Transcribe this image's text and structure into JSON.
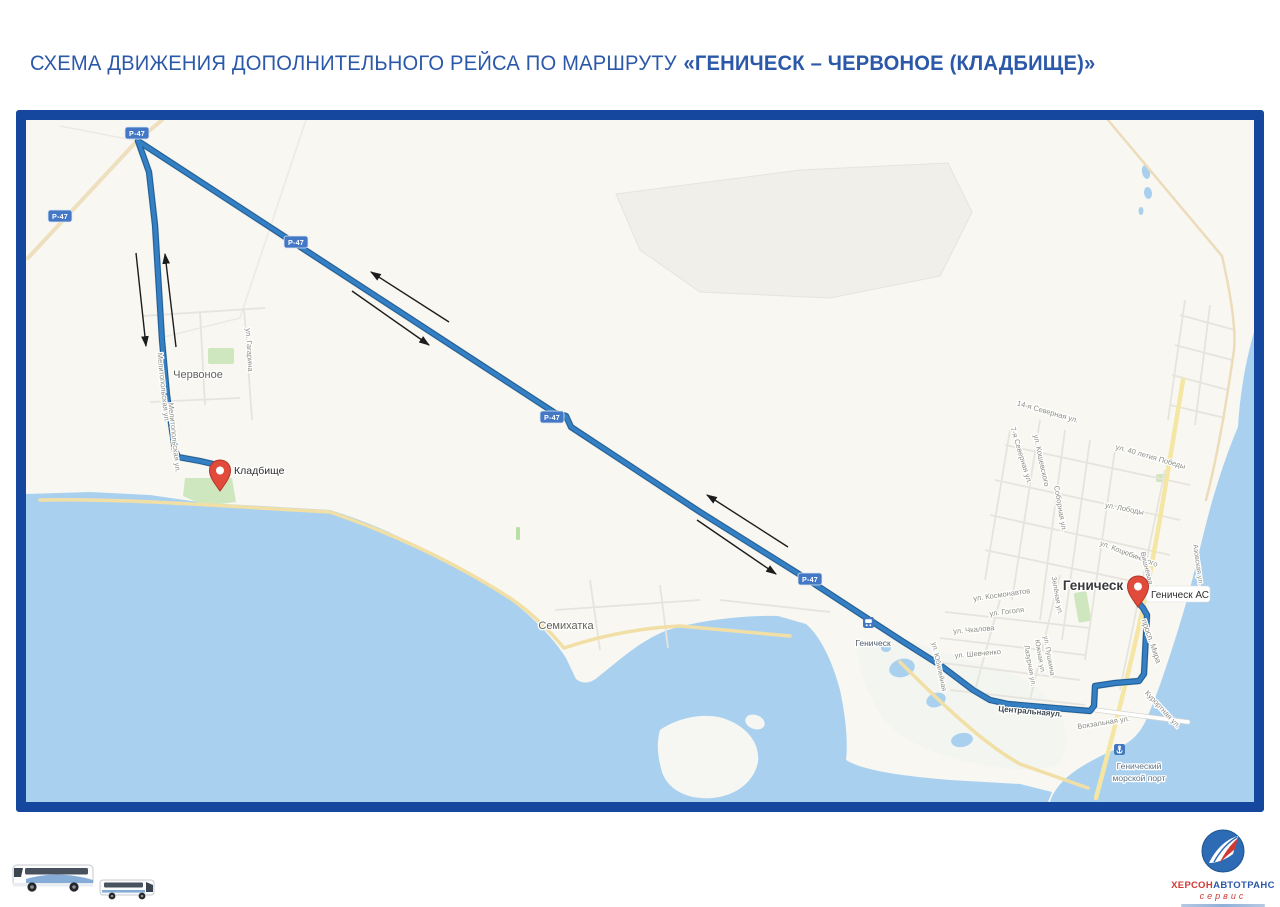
{
  "title": {
    "prefix": "СХЕМА ДВИЖЕНИЯ ДОПОЛНИТЕЛЬНОГО РЕЙСА ПО МАРШРУТУ",
    "route_bold": "«ГЕНИЧЕСК – ЧЕРВОНОЕ (КЛАДБИЩЕ)»"
  },
  "colors": {
    "title_blue": "#2b58a8",
    "frame_blue": "#16479f",
    "route_blue": "#3580c4",
    "sea": "#a9d1ef",
    "road_shield_blue": "#4478c4",
    "pin_red": "#e04b3b"
  },
  "map": {
    "labels": [
      {
        "name": "village-label-chervone",
        "text": "Червоное",
        "x": 198,
        "y": 378,
        "size": 11,
        "color": "#63635c"
      },
      {
        "name": "street-label",
        "text": "ул. Гагарина",
        "x": 247,
        "y": 350,
        "size": 7.5,
        "rotate": 87
      },
      {
        "name": "street-label",
        "text": "Мелитопольская ул.",
        "x": 161,
        "y": 388,
        "size": 7.5,
        "rotate": 84
      },
      {
        "name": "street-label",
        "text": "Мелитопольская ул.",
        "x": 172,
        "y": 438,
        "size": 7.5,
        "rotate": 84
      },
      {
        "name": "village-label-semikhatka",
        "text": "Семихатка",
        "x": 566,
        "y": 629,
        "size": 11,
        "color": "#63635c"
      },
      {
        "name": "train-station-label",
        "text": "Геническ",
        "x": 873,
        "y": 646,
        "size": 8.5,
        "color": "#4e5d6b"
      },
      {
        "name": "street-label",
        "text": "14-я Северная ул.",
        "x": 1047,
        "y": 414,
        "size": 7.5,
        "rotate": 16
      },
      {
        "name": "street-label",
        "text": "7-я Северная ул.",
        "x": 1019,
        "y": 456,
        "size": 7.5,
        "rotate": 73
      },
      {
        "name": "street-label",
        "text": "ул. Кошевского",
        "x": 1039,
        "y": 461,
        "size": 7.5,
        "rotate": 78
      },
      {
        "name": "street-label",
        "text": "ул. 40 летия Победы",
        "x": 1150,
        "y": 459,
        "size": 7.5,
        "rotate": 16
      },
      {
        "name": "street-label",
        "text": "ул. Лободы",
        "x": 1124,
        "y": 511,
        "size": 7.5,
        "rotate": 11
      },
      {
        "name": "street-label",
        "text": "Соборная ул.",
        "x": 1058,
        "y": 509,
        "size": 7.5,
        "rotate": 80
      },
      {
        "name": "street-label",
        "text": "ул. Коцюбинского",
        "x": 1128,
        "y": 556,
        "size": 7.5,
        "rotate": 21
      },
      {
        "name": "street-label",
        "text": "Вишнёвая ул.",
        "x": 1146,
        "y": 574,
        "size": 7,
        "rotate": 76
      },
      {
        "name": "street-label",
        "text": "Азовская ул.",
        "x": 1196,
        "y": 565,
        "size": 7,
        "rotate": 82
      },
      {
        "name": "city-label-genichesk",
        "text": "Геническ",
        "x": 1093,
        "y": 590,
        "size": 13.5,
        "color": "#3a3a3c",
        "weight": 700
      },
      {
        "name": "street-label",
        "text": "ул. Космонавтов",
        "x": 1002,
        "y": 597,
        "size": 7.5,
        "rotate": -8
      },
      {
        "name": "street-label",
        "text": "Зелёная ул.",
        "x": 1055,
        "y": 596,
        "size": 7,
        "rotate": 80
      },
      {
        "name": "street-label",
        "text": "ул. Гоголя",
        "x": 1007,
        "y": 614,
        "size": 7.5,
        "rotate": -7
      },
      {
        "name": "street-label",
        "text": "ул. Чкалова",
        "x": 974,
        "y": 632,
        "size": 7.5,
        "rotate": -5
      },
      {
        "name": "street-label",
        "text": "ул. Шевченко",
        "x": 978,
        "y": 656,
        "size": 7.5,
        "rotate": -5
      },
      {
        "name": "street-label",
        "text": "ул. Пушкина",
        "x": 1047,
        "y": 656,
        "size": 7,
        "rotate": 80
      },
      {
        "name": "street-label",
        "text": "Южная ул.",
        "x": 1038,
        "y": 657,
        "size": 7,
        "rotate": 80
      },
      {
        "name": "street-label",
        "text": "Лазурная ул.",
        "x": 1028,
        "y": 666,
        "size": 7,
        "rotate": 80
      },
      {
        "name": "street-label",
        "text": "ул. Юбилейная",
        "x": 937,
        "y": 667,
        "size": 7,
        "rotate": 78
      },
      {
        "name": "street-label",
        "text": "просп. Мира",
        "x": 1149,
        "y": 642,
        "size": 8,
        "rotate": 71
      },
      {
        "name": "street-label",
        "text": "Центральнаяул.",
        "x": 1030,
        "y": 714,
        "size": 8,
        "rotate": 5,
        "color": "#3e4850",
        "weight": 600
      },
      {
        "name": "street-label",
        "text": "Вокзальная ул.",
        "x": 1104,
        "y": 725,
        "size": 7.5,
        "rotate": -9
      },
      {
        "name": "street-label",
        "text": "Курортная ул.",
        "x": 1161,
        "y": 711,
        "size": 7.5,
        "rotate": 47
      },
      {
        "name": "sea-port-label-line1",
        "text": "Генический",
        "x": 1139,
        "y": 769,
        "size": 8.5,
        "color": "#5d7588"
      },
      {
        "name": "sea-port-label-line2",
        "text": "морской порт",
        "x": 1139,
        "y": 781,
        "size": 8.5,
        "color": "#5d7588"
      }
    ],
    "road_shields": {
      "label": "Р-47",
      "positions": [
        {
          "x": 60,
          "y": 216
        },
        {
          "x": 137,
          "y": 133
        },
        {
          "x": 296,
          "y": 242
        },
        {
          "x": 552,
          "y": 417
        },
        {
          "x": 810,
          "y": 579
        }
      ]
    },
    "pins": [
      {
        "name": "cemetery-pin",
        "tip_x": 220,
        "tip_y": 491,
        "label": "Кладбище",
        "label_x": 234,
        "label_y": 474,
        "label_size": 10.5
      },
      {
        "name": "bus-station-pin",
        "tip_x": 1138,
        "tip_y": 607,
        "label": "Геническ АС",
        "label_x": 1151,
        "label_y": 598,
        "label_size": 10,
        "boxed": true,
        "box": {
          "x": 1146,
          "y": 586,
          "w": 64,
          "h": 16
        }
      }
    ]
  },
  "footer": {
    "logo": {
      "brand_red": "ХЕРСОН",
      "brand_blue": "АВТОТРАНС",
      "subtitle": "сервис"
    }
  }
}
